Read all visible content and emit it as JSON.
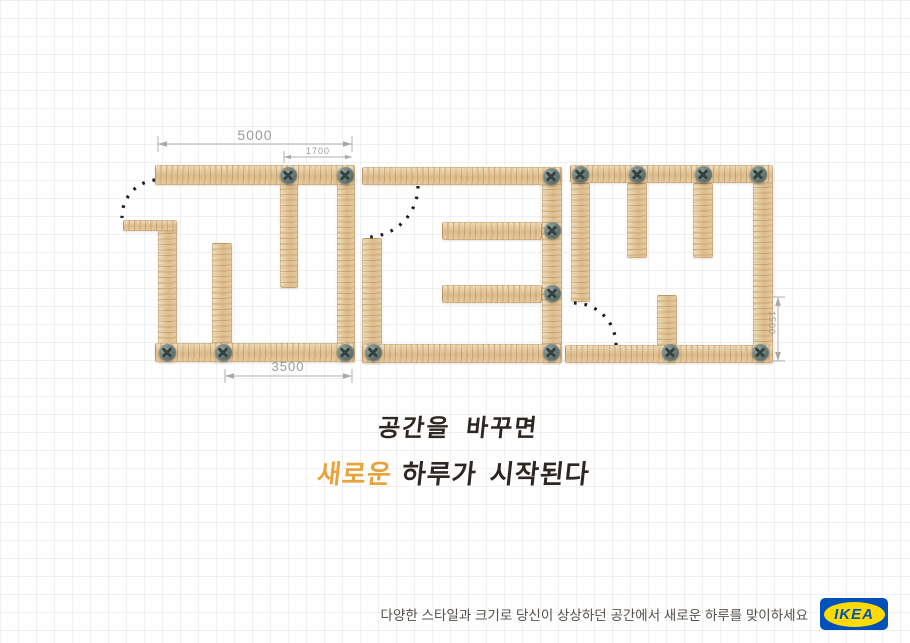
{
  "dims": {
    "w5000": "5000",
    "w1700": "1700",
    "w3500": "3500",
    "h1500": "1500"
  },
  "slogan": {
    "line1": "공간을 바꾸면",
    "line2_highlight": "새로운",
    "line2_rest": "하루가 시작된다"
  },
  "footer": {
    "tagline": "다양한 스타일과 크기로 당신이 상상하던 공간에서 새로운 하루를 맞이하세요",
    "logo_text": "IKEA"
  },
  "colors": {
    "highlight_orange": "#e8a33c",
    "ink": "#2e2620",
    "dimension_gray": "#9a9a9a",
    "ikea_blue": "#0051ba",
    "ikea_yellow": "#ffdb00",
    "wood_light": "#f1e2c3",
    "wood_dark": "#dcba8a"
  }
}
